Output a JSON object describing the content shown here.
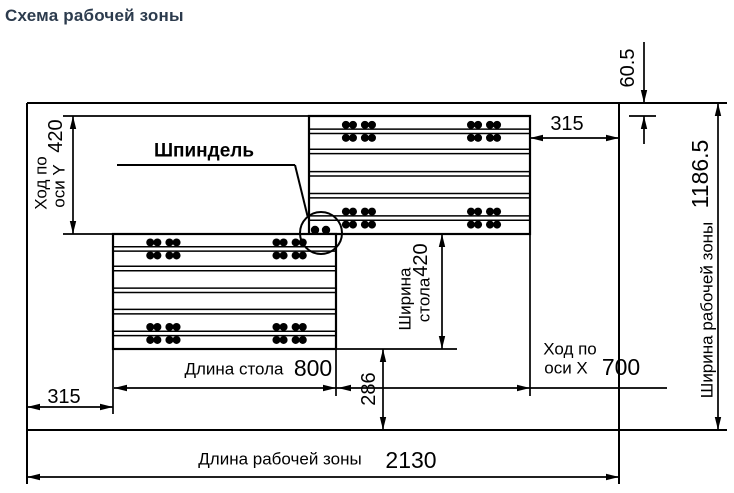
{
  "title": "Схема рабочей зоны",
  "colors": {
    "line": "#000000",
    "title_text": "#2c3b4d",
    "background": "#ffffff"
  },
  "diagram": {
    "spindle": {
      "label": "Шпиндель"
    },
    "y_travel": {
      "label_line1": "Ход по",
      "label_line2": "оси Y",
      "value": "420"
    },
    "top_edge_offset": {
      "value": "60.5"
    },
    "right_table_offset": {
      "value": "315"
    },
    "work_zone_width": {
      "label": "Ширина рабочей зоны",
      "value": "1186.5"
    },
    "table_width": {
      "label_line1": "Ширина",
      "label_line2": "стола",
      "value": "420"
    },
    "table_length": {
      "label": "Длина стола",
      "value": "800"
    },
    "x_travel": {
      "label_line1": "Ход по",
      "label_line2": "оси X",
      "value": "700"
    },
    "table_bottom_offset": {
      "value": "286"
    },
    "left_table_offset": {
      "value": "315"
    },
    "work_zone_length": {
      "label": "Длина рабочей зоны",
      "value": "2130"
    }
  }
}
